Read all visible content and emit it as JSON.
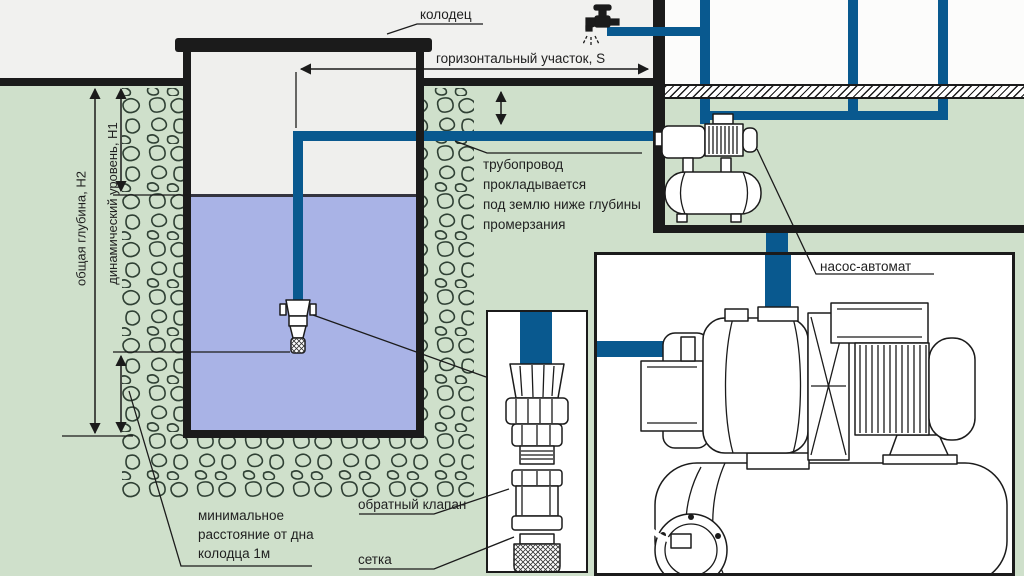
{
  "colors": {
    "background": "#cfe0cb",
    "sky": "#f1f1ef",
    "house_interior": "#fcfcfb",
    "well_interior": "#efefed",
    "water": "#a9b3e6",
    "water_line": "#34343f",
    "pipe": "#09598f",
    "line": "#1b1b1b",
    "stone_outline": "#2f4034",
    "text": "#1f1f1f",
    "box_bg": "#ffffff"
  },
  "labels": {
    "well": "колодец",
    "horizontal_section": "горизонтальный участок, S",
    "pipeline_note_line1": "трубопровод",
    "pipeline_note_line2": "прокладывается",
    "pipeline_note_line3": "под землю ниже глубины",
    "pipeline_note_line4": "промерзания",
    "total_depth": "общая глубина, Н2",
    "dynamic_level": "динамический уровень, Н1",
    "pump_station": "насос-автомат",
    "min_distance_line1": "минимальное",
    "min_distance_line2": "расстояние от дна",
    "min_distance_line3": "колодца 1м",
    "check_valve": "обратный клапан",
    "mesh": "сетка"
  },
  "icons": {
    "faucet": "faucet",
    "foot_valve": "foot-valve-intake",
    "pump_small": "pump-station-small",
    "pump_large": "pump-station-detail",
    "check_valve_assembly": "check-valve-assembly",
    "strainer": "mesh-strainer"
  }
}
